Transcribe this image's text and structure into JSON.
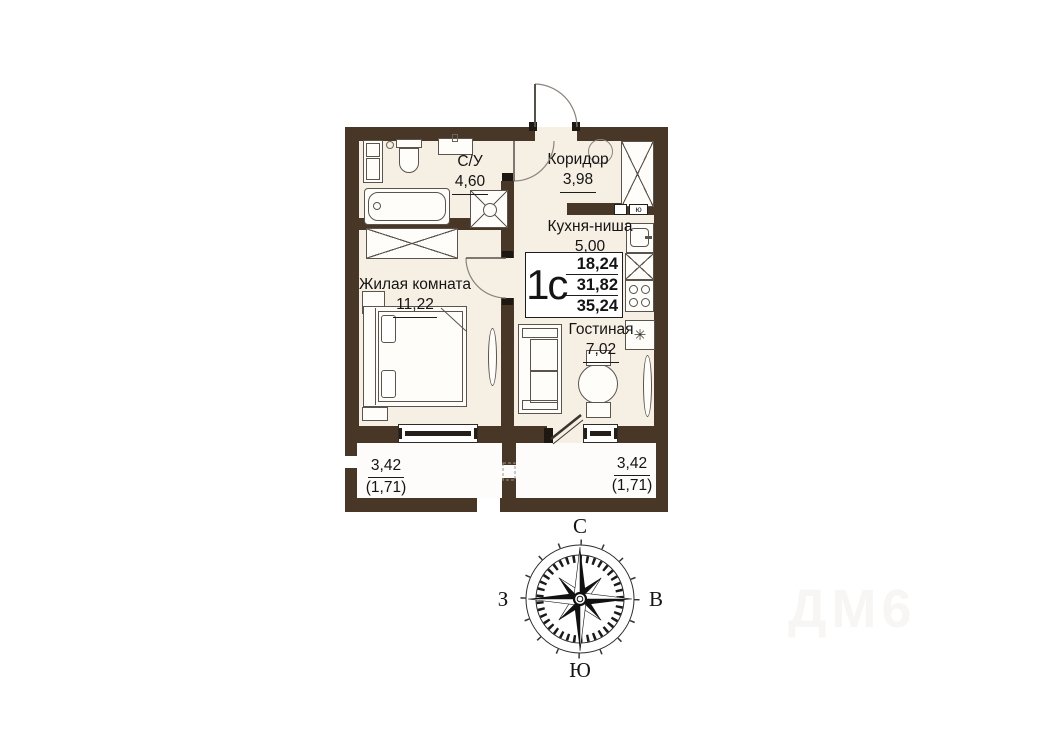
{
  "plan": {
    "unit": {
      "label": "1с",
      "area_living": "18,24",
      "area_total": "31,82",
      "area_overall": "35,24"
    },
    "rooms": {
      "bathroom": {
        "name": "С/У",
        "area": "4,60"
      },
      "corridor": {
        "name": "Коридор",
        "area": "3,98"
      },
      "kitchen": {
        "name": "Кухня-ниша",
        "area": "5,00"
      },
      "living": {
        "name": "Жилая комната",
        "area": "11,22"
      },
      "lounge": {
        "name": "Гостиная",
        "area": "7,02"
      }
    },
    "balcony_left": {
      "area": "3,42",
      "coeff": "(1,71)"
    },
    "balcony_right": {
      "area": "3,42",
      "coeff": "(1,71)"
    },
    "wall_marker": "ю",
    "fridge_symbol": "✳"
  },
  "compass": {
    "north": "С",
    "east": "В",
    "south": "Ю",
    "west": "З"
  },
  "watermark": "ДМ6",
  "colors": {
    "wall": "#483726",
    "floor": "#f6efe3",
    "balcony_floor": "#fdfcfa",
    "furniture_line": "#5a544c",
    "text": "#141414"
  }
}
